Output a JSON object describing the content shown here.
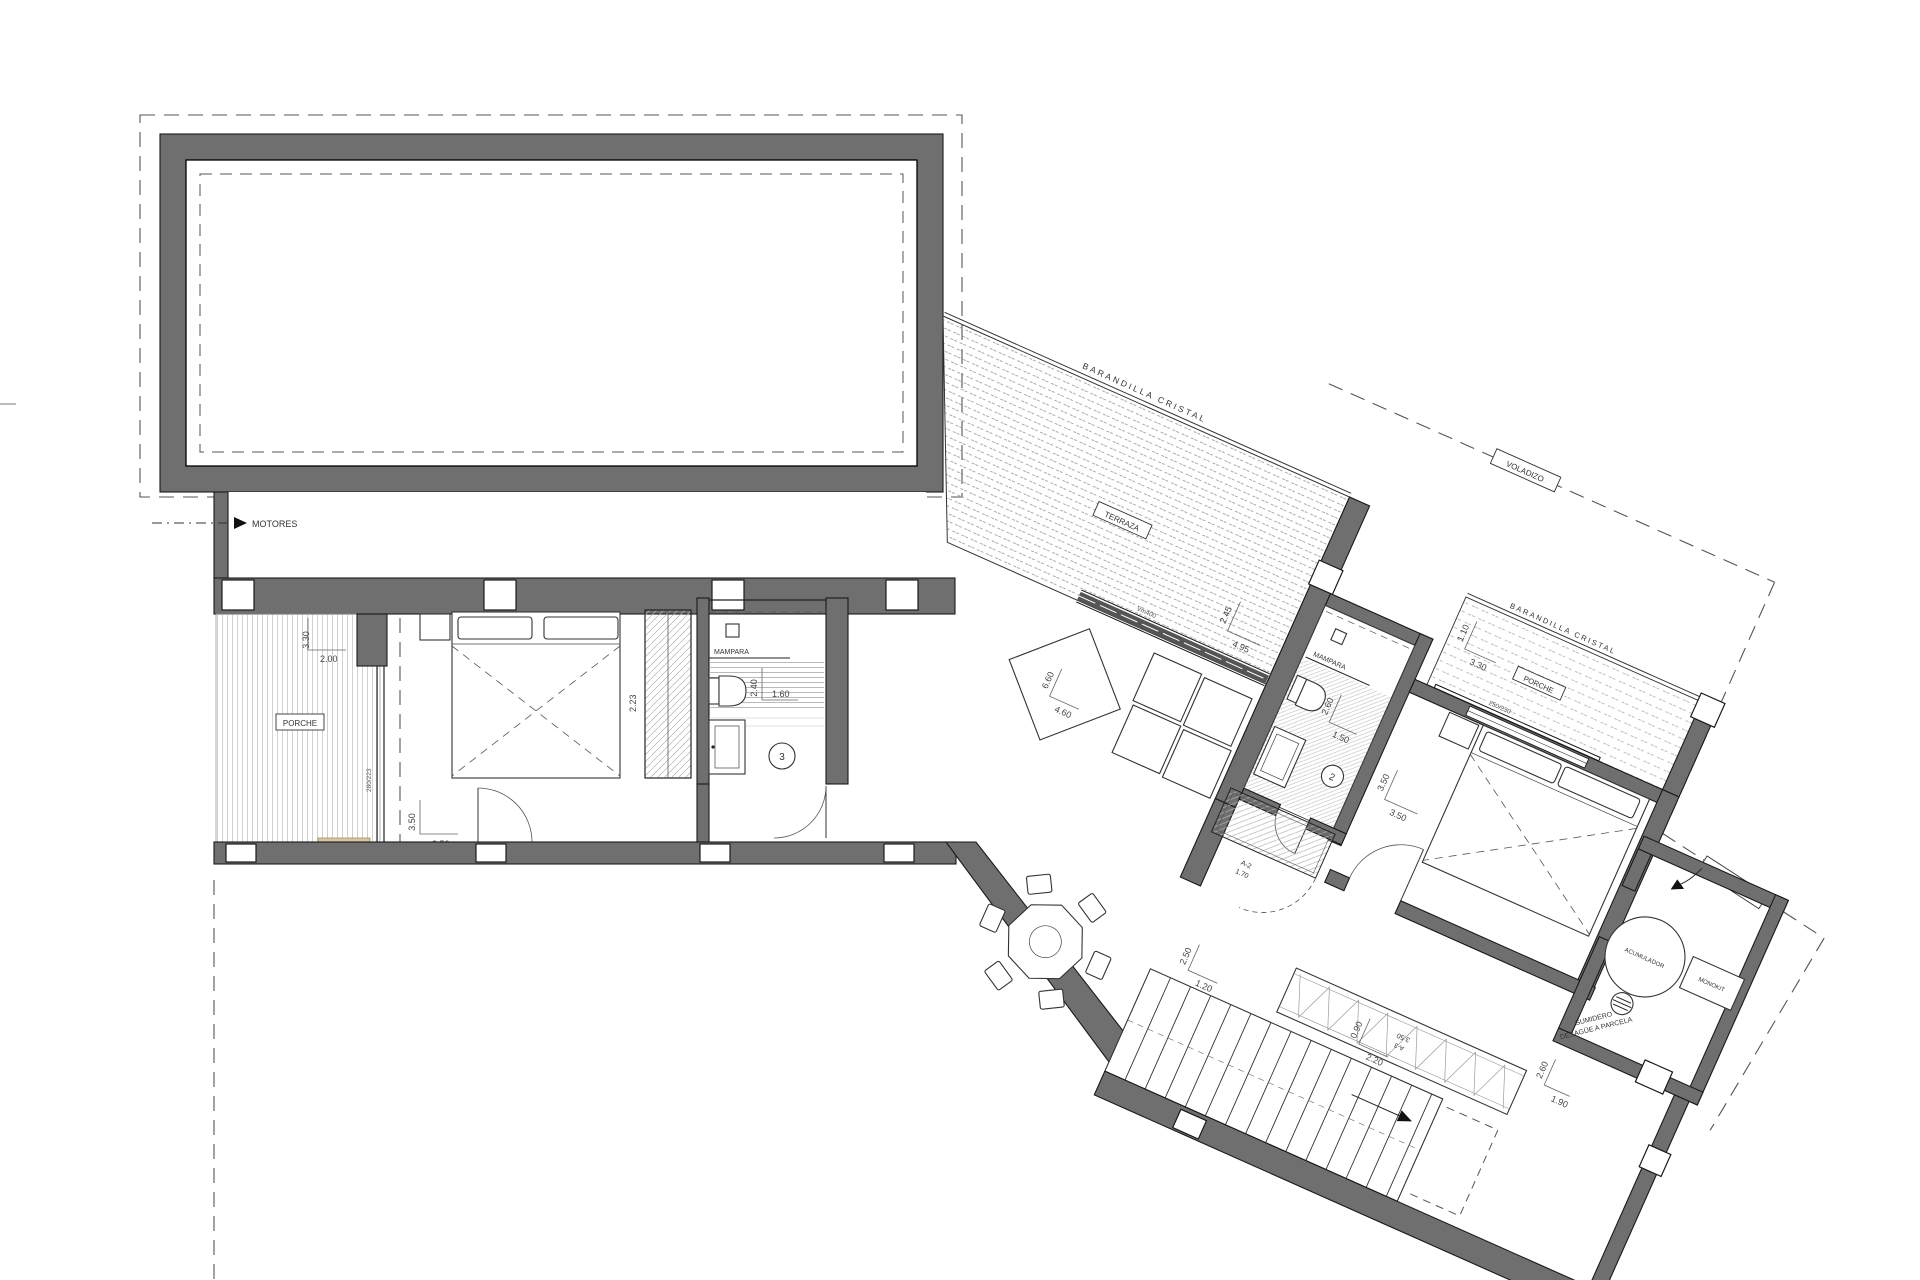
{
  "drawing": {
    "type": "architectural floor plan",
    "labels": {
      "motores": "MOTORES",
      "porche": "PORCHE",
      "porche2": "PORCHE",
      "terraza": "TERRAZA",
      "barandilla": "BARANDILLA CRISTAL",
      "barandilla2": "BARANDILLA CRISTAL",
      "voladizo": "VOLADIZO",
      "voladizo2": "VOLADIZO",
      "mampara": "MAMPARA",
      "mampara2": "MAMPARA",
      "acumulador": "ACUMULADOR",
      "monokit": "MONOKIT",
      "sumidero": "SUMIDERO",
      "desague": "DESAGÜE A PARCELA",
      "a3": "A-3",
      "a3s": "3.50",
      "a2": "A-2",
      "a2s": "1.70",
      "code1": "280/223",
      "code2": "250/230",
      "code3": "Vm400",
      "n2": "2",
      "n3": "3"
    },
    "dims": {
      "pl_v": "3.30",
      "pl_h": "2.00",
      "b1_v": "3.50",
      "b1_h": "3.50",
      "w1": "2.23",
      "ba1_v": "2.40",
      "ba1_h": "1.60",
      "t_v": "2.45",
      "t_h": "4.95",
      "lv_v": "6.60",
      "lv_h": "4.60",
      "p2_v": "1.10",
      "p2_h": "3.30",
      "ba2_v": "2.60",
      "ba2_h": "1.50",
      "b2_v": "3.50",
      "b2_h": "3.50",
      "s1_v": "2.50",
      "s1_h": "1.20",
      "s2_v": "0.90",
      "s2_h": "2.20",
      "u_v": "2.60",
      "u_h": "1.90"
    }
  }
}
